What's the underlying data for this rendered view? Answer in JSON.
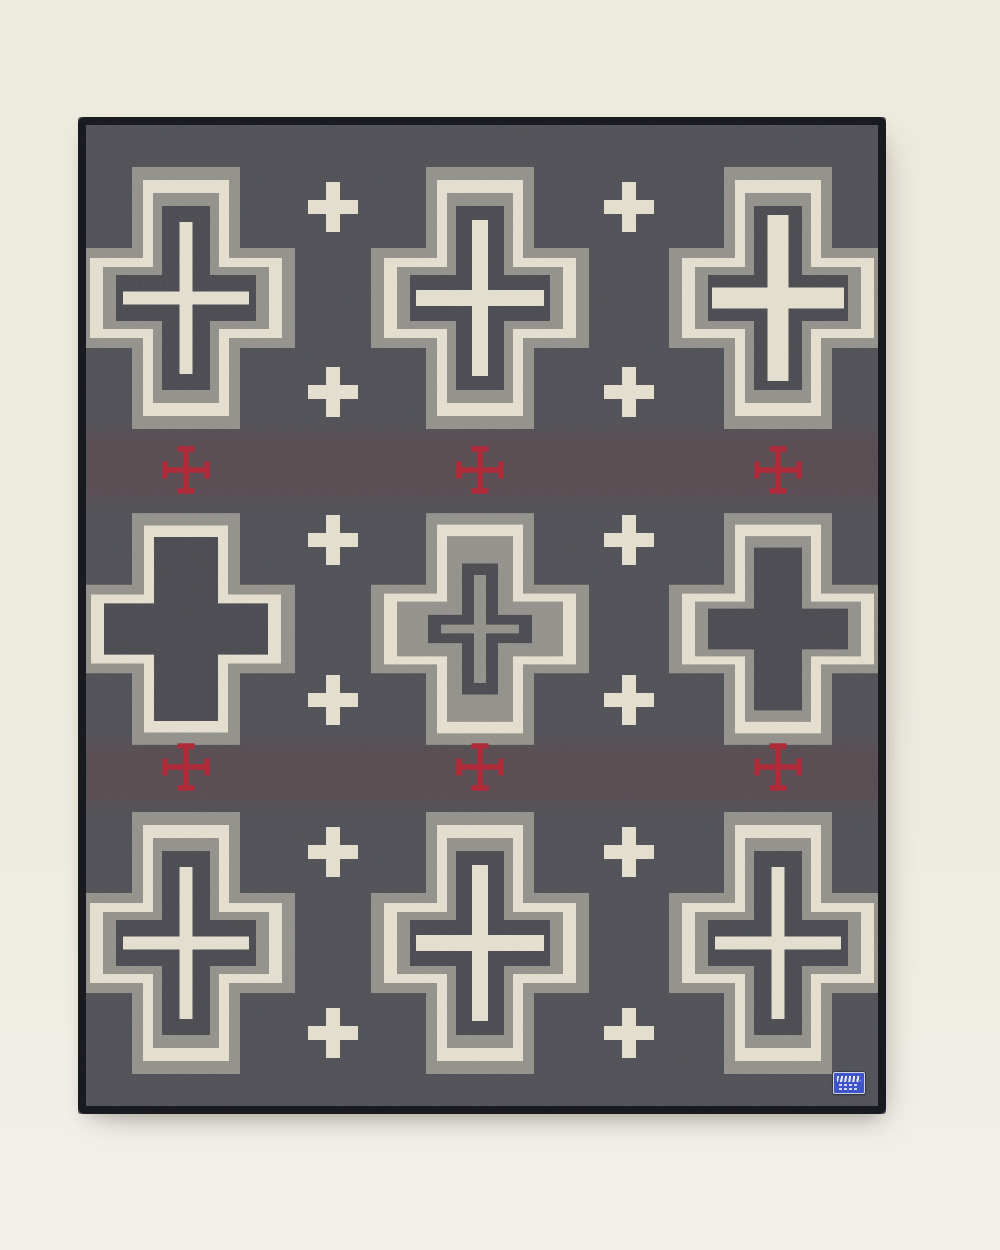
{
  "scene": {
    "width": 1000,
    "height": 1250,
    "background_top": "#edeade",
    "background_bottom": "#f2f0ea"
  },
  "blanket": {
    "left": 78,
    "top": 117,
    "width": 808,
    "height": 997,
    "binding_width": 8,
    "palette": {
      "field": "#4b4c52",
      "gray_band": "#93918a",
      "cream": "#e9e3d2",
      "dark_center": "#45464c",
      "red": "#b01e2e",
      "band_tint": "#5d3e45",
      "binding": "#1a1b20"
    },
    "columns": [
      108,
      402,
      700
    ],
    "rows": [
      {
        "cy": 181,
        "scale_y": 1.0
      },
      {
        "cy": 512,
        "scale_y": 0.885
      },
      {
        "cy": 826,
        "scale_y": 1.0
      }
    ],
    "tint_bands": [
      {
        "y": 306,
        "height": 86
      },
      {
        "y": 618,
        "height": 78
      }
    ],
    "cross_grid": [
      [
        "standard_thin",
        "standard_med",
        "bold_inner"
      ],
      [
        "plain_wide",
        "inverse",
        "plain"
      ],
      [
        "standard_thin",
        "standard_med",
        "standard_thin"
      ]
    ],
    "variants": {
      "standard_thin": {
        "layers": [
          [
            "gray_band",
            218,
            262,
            108,
            100
          ],
          [
            "cream",
            192,
            236,
            86,
            80
          ],
          [
            "gray_band",
            166,
            210,
            66,
            62
          ],
          [
            "dark_center",
            140,
            184,
            48,
            46
          ]
        ],
        "inner": {
          "color": "cream",
          "v": [
            13,
            152
          ],
          "h": [
            126,
            13
          ]
        }
      },
      "standard_med": {
        "layers": [
          [
            "gray_band",
            218,
            262,
            108,
            100
          ],
          [
            "cream",
            192,
            236,
            86,
            80
          ],
          [
            "gray_band",
            166,
            210,
            66,
            62
          ],
          [
            "dark_center",
            140,
            184,
            48,
            46
          ]
        ],
        "inner": {
          "color": "cream",
          "v": [
            16,
            156
          ],
          "h": [
            128,
            16
          ]
        }
      },
      "bold_inner": {
        "layers": [
          [
            "gray_band",
            218,
            262,
            108,
            100
          ],
          [
            "cream",
            192,
            236,
            86,
            80
          ],
          [
            "gray_band",
            166,
            210,
            66,
            62
          ],
          [
            "dark_center",
            140,
            184,
            48,
            46
          ]
        ],
        "inner": {
          "color": "cream",
          "v": [
            21,
            166
          ],
          "h": [
            132,
            21
          ]
        }
      },
      "plain": {
        "layers": [
          [
            "gray_band",
            218,
            262,
            108,
            100
          ],
          [
            "cream",
            192,
            236,
            86,
            80
          ],
          [
            "gray_band",
            166,
            210,
            66,
            62
          ],
          [
            "dark_center",
            140,
            184,
            48,
            46
          ]
        ],
        "inner": null
      },
      "plain_wide": {
        "layers": [
          [
            "gray_band",
            218,
            262,
            108,
            100
          ],
          [
            "cream",
            190,
            234,
            84,
            78
          ],
          [
            "dark_center",
            164,
            208,
            64,
            58
          ]
        ],
        "inner": null
      },
      "inverse": {
        "layers": [
          [
            "gray_band",
            218,
            262,
            108,
            100
          ],
          [
            "cream",
            192,
            236,
            86,
            80
          ],
          [
            "gray_band",
            166,
            210,
            66,
            62
          ],
          [
            "dark_center",
            104,
            148,
            36,
            32
          ],
          [
            "gray_band",
            78,
            122,
            12,
            10
          ]
        ],
        "inner": null
      }
    },
    "small_plus": {
      "size": 50,
      "bar": 14,
      "color": "cream",
      "columns": [
        255,
        551
      ],
      "rows": [
        90,
        275,
        423,
        583,
        735,
        916
      ]
    },
    "red_plus": {
      "span": 42,
      "bar": 5.5,
      "cap_length": 17,
      "color": "red",
      "columns": [
        108,
        402,
        700
      ],
      "rows": [
        353,
        650
      ]
    },
    "label": {
      "left": 833,
      "top": 1072,
      "width": 30,
      "height": 20,
      "color": "#3f55c8",
      "trim": "#ccd2e4"
    }
  }
}
